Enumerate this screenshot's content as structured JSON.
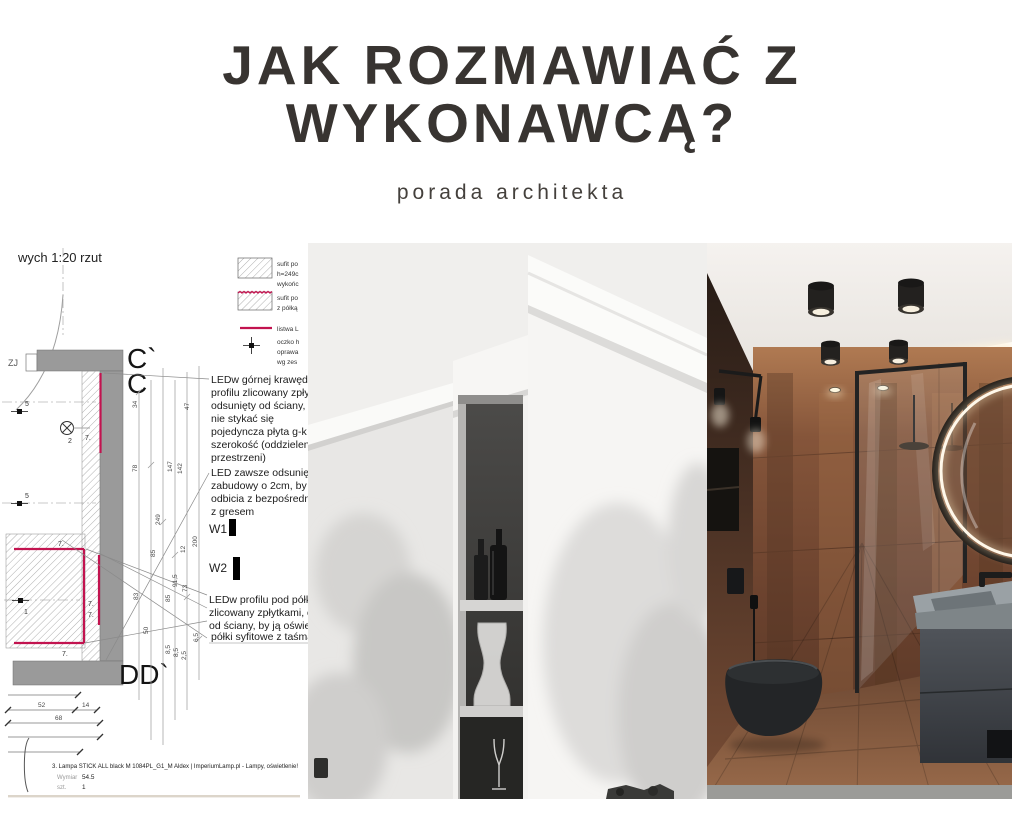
{
  "header": {
    "title_line1": "JAK ROZMAWIAĆ Z",
    "title_line2": "WYKONAWCĄ?",
    "subtitle": "porada architekta"
  },
  "palette": {
    "title_color": "#383431",
    "accent_red": "#c2134f",
    "wall_gray": "#9a9a9a",
    "copper": "#7c4e36",
    "fixture_black": "#1f2123"
  },
  "drawing": {
    "scale_label": "wych 1:20 rzut",
    "edge_label": "ZJ",
    "legend": {
      "item1_lines": [
        "sufit po",
        "h=249c",
        "wykońc"
      ],
      "item2_lines": [
        "sufit po",
        "z półką"
      ],
      "item3_lines": [
        "listwa L"
      ],
      "item4_lines": [
        "oczko h",
        "oprawa",
        "wg zes"
      ]
    },
    "section_marks": {
      "c_prime": "C`",
      "c": "C",
      "dd": "DD`"
    },
    "wall_marks": {
      "w1": "W1",
      "w2": "W2"
    },
    "symbol_labels": {
      "five": "5",
      "two": "2",
      "one": "1",
      "seven": "7."
    },
    "note1_lines": [
      "LEDw górnej krawędzi",
      "profilu zlicowany zpłytk",
      "odsunięty od ściany, b",
      "nie stykać się",
      "pojedyncza płyta g-k 1",
      "szerokość (oddzielenie",
      "przestrzeni)"
    ],
    "note2_lines": [
      "LED zawsze odsunięty",
      "zabudowy o 2cm, by u",
      "odbicia z bezpośredni",
      "z gresem"
    ],
    "note3_lines": [
      "LEDw profilu pod półką,",
      "zlicowany zpłytkami, od",
      "od ściany, by ją oświetla",
      "półki syfitowe z taśman"
    ],
    "dims_vertical": [
      "34",
      "47",
      "78",
      "147",
      "142",
      "249",
      "85",
      "12",
      "200",
      "83",
      "85",
      "91,5",
      "73",
      "50",
      "8,5",
      "8,5",
      "2,5",
      "6,5"
    ],
    "dims_bottom": [
      "52",
      "14",
      "68"
    ],
    "caption": {
      "item": "3.  Lampa STICK ALL black M 1084PL_G1_M Aldex | ImperiumLamp.pl - Lampy, oświetlenie!",
      "dim_label": "Wymiar",
      "dim_value": "54.5",
      "qty_label": "szt.",
      "qty_value": "1"
    }
  }
}
